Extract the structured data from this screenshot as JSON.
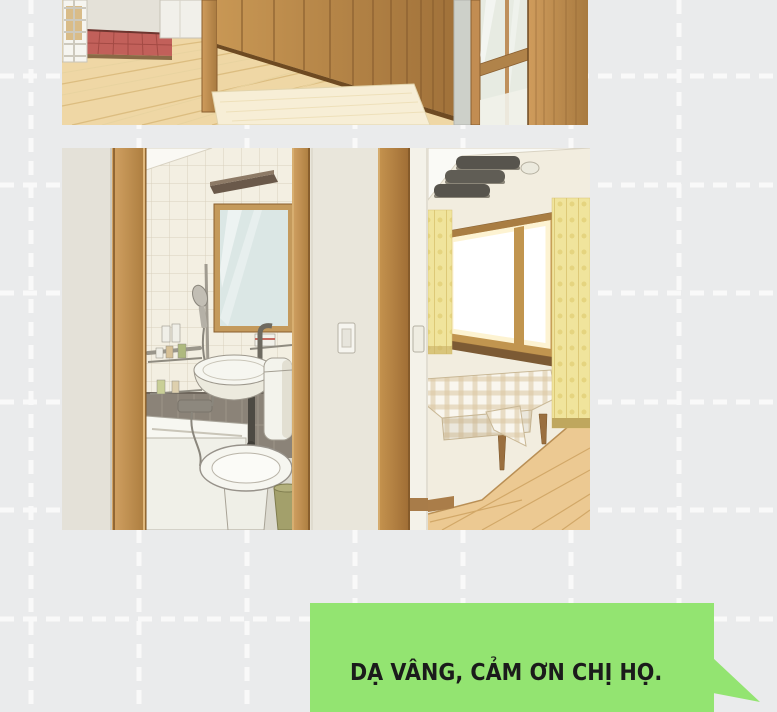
{
  "page": {
    "width": 777,
    "height": 712,
    "kind": "comic page"
  },
  "palette": {
    "background": "#eaebec",
    "grid": "#fcfcfc",
    "bubble_green": "#93e471",
    "ink": "#1b1b1b",
    "wood": "#c28d52",
    "wood_dark": "#8a5f30",
    "floor_wood": "#efd7a5",
    "floor_line": "#dcbd80",
    "tile": "#f3efe2",
    "tile_line": "#d9d1bd",
    "wall_gray": "#e4e1d8",
    "fixture_white": "#f4f4ee",
    "wainscot": "#8b8378",
    "curtain_yellow": "#f0e49c",
    "bin_green": "#a3a06b",
    "bed_check": "#dbc7a2"
  },
  "panels": [
    {
      "name": "hallway",
      "alt": "entry hallway with wooden wardrobe, red tiled entry step and glass panel door"
    },
    {
      "name": "bathroom-bedroom",
      "alt": "bathroom with mirror, shower, tub, sink and toilet seen through a doorway beside a bright bedroom with a checkered bed"
    }
  ],
  "speech_bubble": {
    "text": "DẠ VÂNG, CẢM ƠN CHỊ HỌ."
  }
}
